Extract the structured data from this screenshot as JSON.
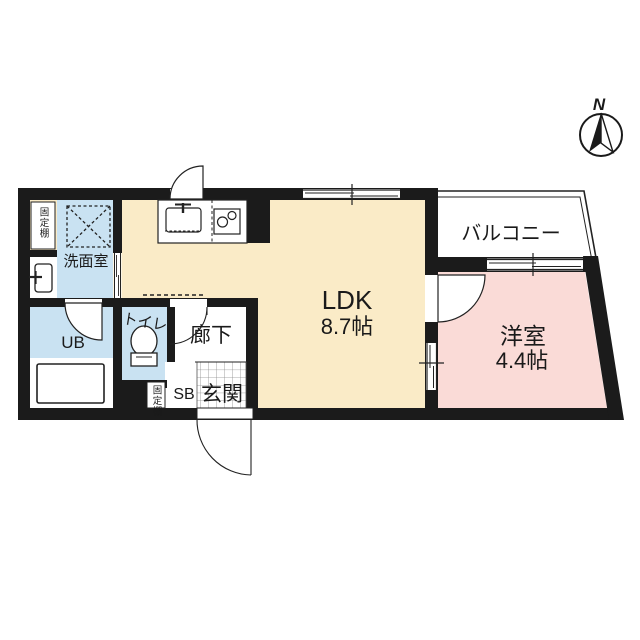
{
  "plan": {
    "type": "floor-plan",
    "compass": {
      "north_label": "N"
    },
    "rooms": {
      "ldk": {
        "name": "LDK",
        "size": "8.7帖"
      },
      "western_room": {
        "name": "洋室",
        "size": "4.4帖"
      },
      "balcony": {
        "name": "バルコニー"
      },
      "corridor": {
        "name": "廊下"
      },
      "entrance": {
        "name": "玄関"
      },
      "shoe_box": {
        "name": "SB"
      },
      "toilet": {
        "name": "トイレ"
      },
      "unit_bath": {
        "name": "UB"
      },
      "washroom": {
        "name": "洗面室"
      },
      "fixed_shelf_top": {
        "name": "固定棚"
      },
      "fixed_shelf_entrance": {
        "name": "固定棚"
      }
    },
    "colors": {
      "wall": "#1b1b1b",
      "ldk_floor": "#faebc7",
      "western_room_floor": "#fadbd7",
      "wet_area_floor": "#c9e2f2",
      "balcony_floor": "#ffffff",
      "tile_line": "#8a8a8a",
      "line": "#222222"
    }
  }
}
